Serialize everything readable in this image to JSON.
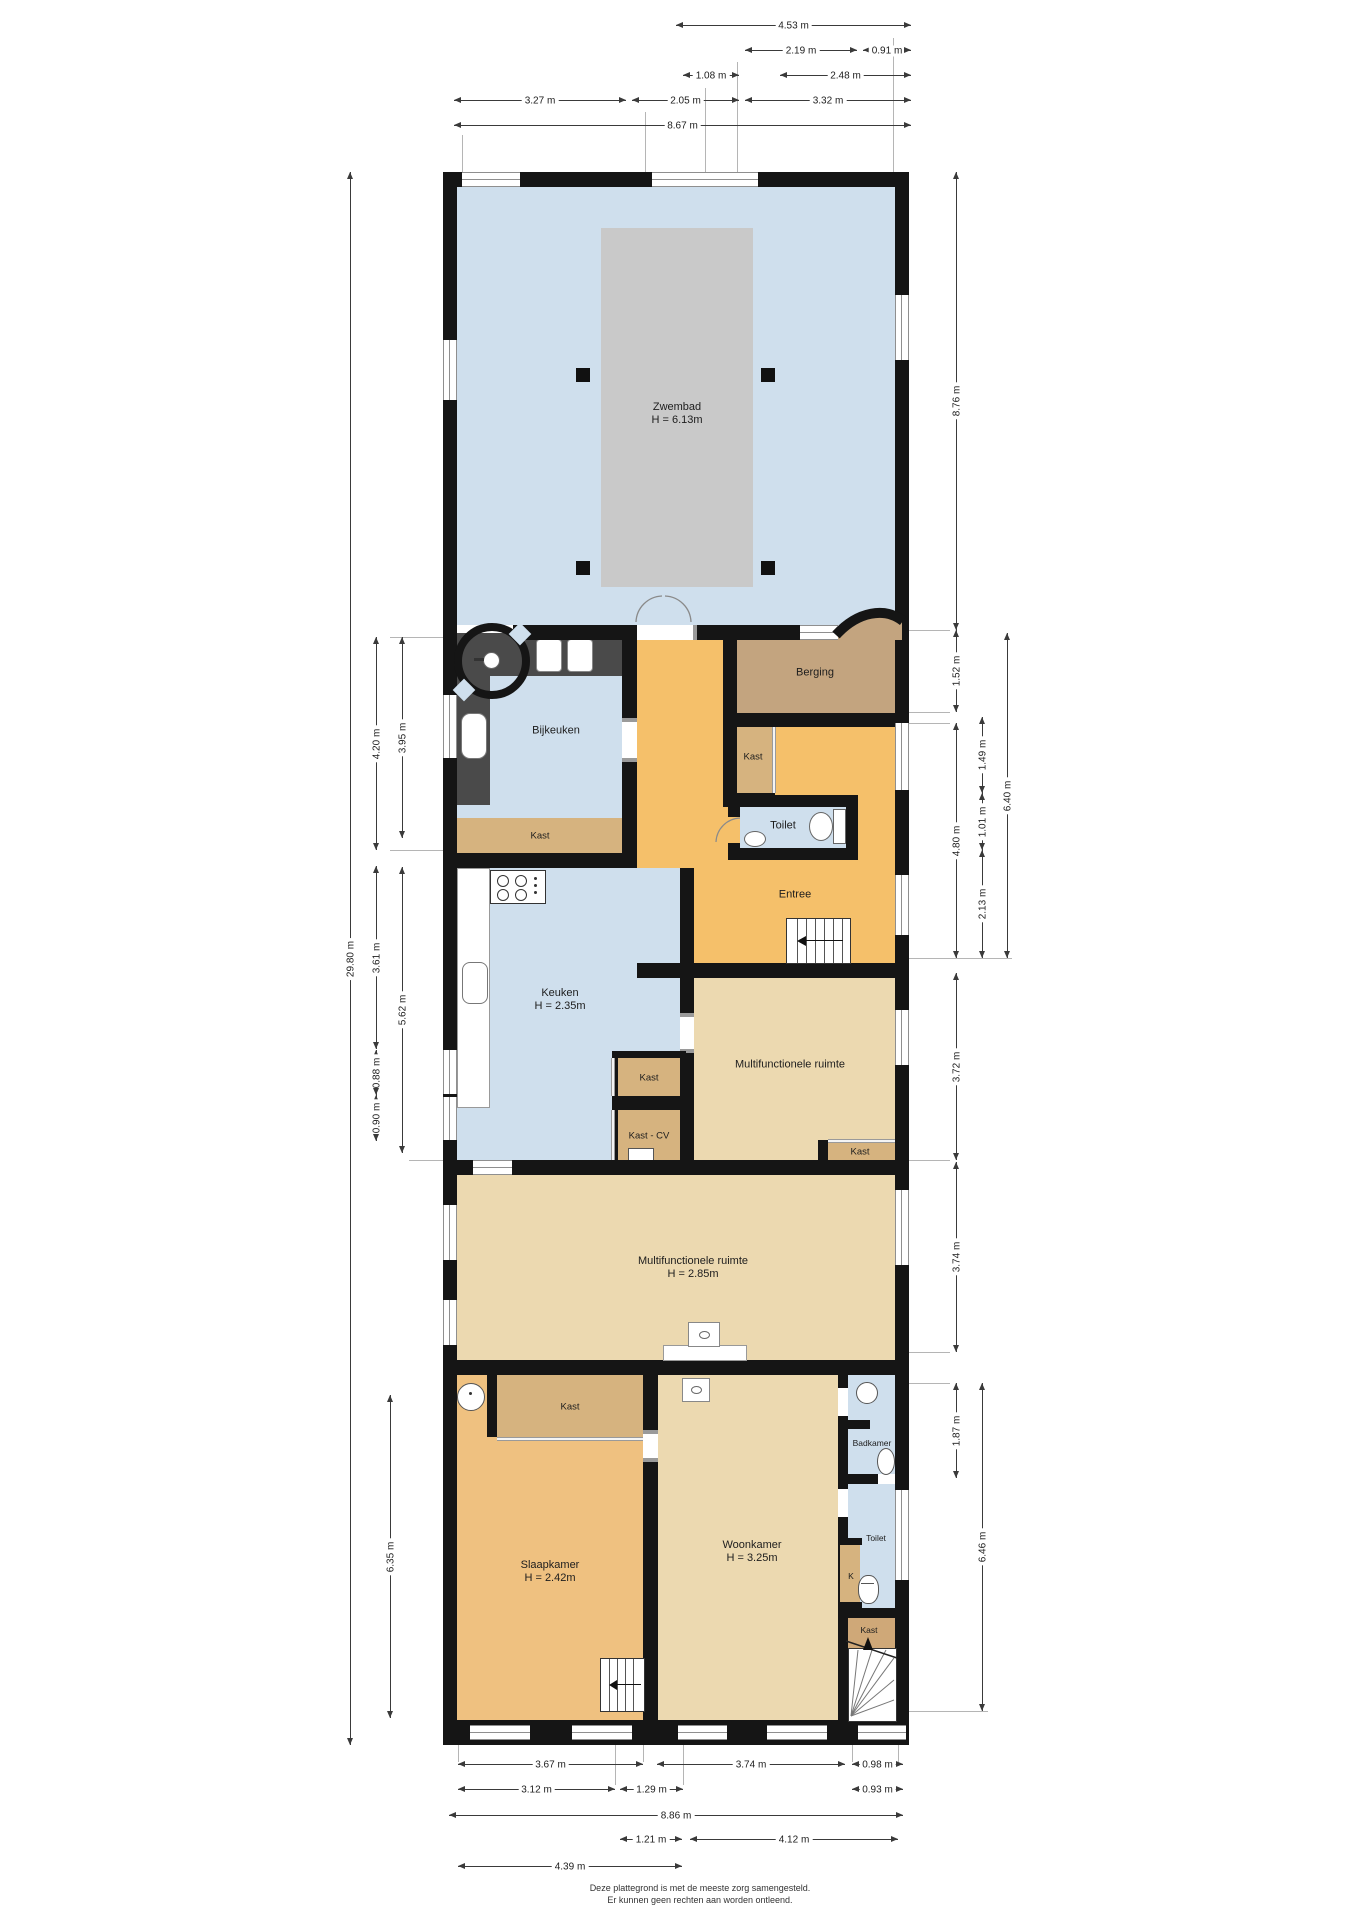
{
  "title": "Plattegrond begane grond",
  "colors": {
    "wall": "#151515",
    "pool_room": "#cfdfed",
    "pool": "#c9c9c9",
    "entree_orange": "#f5c06a",
    "bedroom_orange": "#efc180",
    "living_beige": "#ecd9b0",
    "berging_tan": "#c3a47f",
    "closet_tan": "#d6b37f",
    "wet_room_blue": "#cfdfed"
  },
  "room_labels": [
    {
      "label": "Zwembad",
      "sub": "H = 6.13m",
      "x": 677,
      "y": 414
    },
    {
      "label": "Bijkeuken",
      "x": 556,
      "y": 731
    },
    {
      "label": "Berging",
      "x": 815,
      "y": 673
    },
    {
      "label": "Kast",
      "x": 753,
      "y": 757,
      "size": "sm"
    },
    {
      "label": "Toilet",
      "x": 783,
      "y": 826
    },
    {
      "label": "Kast",
      "x": 540,
      "y": 836,
      "size": "sm"
    },
    {
      "label": "Entree",
      "x": 795,
      "y": 895
    },
    {
      "label": "Keuken",
      "sub": "H = 2.35m",
      "x": 560,
      "y": 1000
    },
    {
      "label": "Multifunctionele ruimte",
      "x": 790,
      "y": 1065
    },
    {
      "label": "Kast",
      "x": 649,
      "y": 1078,
      "size": "sm"
    },
    {
      "label": "Kast - CV",
      "x": 649,
      "y": 1136,
      "size": "sm"
    },
    {
      "label": "Kast",
      "x": 860,
      "y": 1152,
      "size": "sm"
    },
    {
      "label": "Multifunctionele ruimte",
      "sub": "H = 2.85m",
      "x": 693,
      "y": 1268
    },
    {
      "label": "Kast",
      "x": 570,
      "y": 1407,
      "size": "sm"
    },
    {
      "label": "Slaapkamer",
      "sub": "H = 2.42m",
      "x": 550,
      "y": 1572
    },
    {
      "label": "Woonkamer",
      "sub": "H = 3.25m",
      "x": 752,
      "y": 1552
    },
    {
      "label": "Badkamer",
      "x": 872,
      "y": 1443,
      "size": "xs"
    },
    {
      "label": "Toilet",
      "x": 876,
      "y": 1538,
      "size": "xs"
    },
    {
      "label": "K",
      "x": 851,
      "y": 1576,
      "size": "xs"
    },
    {
      "label": "Kast",
      "x": 869,
      "y": 1630,
      "size": "xs"
    }
  ],
  "dims_top": [
    {
      "label": "4.53 m",
      "x1": 676,
      "x2": 911,
      "y": 25
    },
    {
      "label": "2.19 m",
      "x1": 745,
      "x2": 857,
      "y": 50
    },
    {
      "label": "0.91 m",
      "x1": 863,
      "x2": 911,
      "y": 50
    },
    {
      "label": "1.08 m",
      "x1": 683,
      "x2": 739,
      "y": 75
    },
    {
      "label": "2.48 m",
      "x1": 780,
      "x2": 911,
      "y": 75
    },
    {
      "label": "3.27 m",
      "x1": 454,
      "x2": 626,
      "y": 100
    },
    {
      "label": "2.05 m",
      "x1": 632,
      "x2": 739,
      "y": 100
    },
    {
      "label": "3.32 m",
      "x1": 745,
      "x2": 911,
      "y": 100
    },
    {
      "label": "8.67 m",
      "x1": 454,
      "x2": 911,
      "y": 125
    }
  ],
  "dims_bottom": [
    {
      "label": "3.67 m",
      "x1": 458,
      "x2": 643,
      "y": 1764
    },
    {
      "label": "3.74 m",
      "x1": 657,
      "x2": 845,
      "y": 1764
    },
    {
      "label": "0.98 m",
      "x1": 852,
      "x2": 903,
      "y": 1764
    },
    {
      "label": "3.12 m",
      "x1": 458,
      "x2": 615,
      "y": 1789
    },
    {
      "label": "1.29 m",
      "x1": 620,
      "x2": 683,
      "y": 1789
    },
    {
      "label": "0.93 m",
      "x1": 852,
      "x2": 903,
      "y": 1789
    },
    {
      "label": "8.86 m",
      "x1": 449,
      "x2": 903,
      "y": 1815
    },
    {
      "label": "1.21 m",
      "x1": 620,
      "x2": 682,
      "y": 1839
    },
    {
      "label": "4.12 m",
      "x1": 690,
      "x2": 898,
      "y": 1839
    },
    {
      "label": "4.39 m",
      "x1": 458,
      "x2": 682,
      "y": 1866
    }
  ],
  "dims_left": [
    {
      "label": "29.80 m",
      "x": 350,
      "y1": 172,
      "y2": 1745
    },
    {
      "label": "4.20 m",
      "x": 376,
      "y1": 637,
      "y2": 850
    },
    {
      "label": "3.95 m",
      "x": 402,
      "y1": 637,
      "y2": 838
    },
    {
      "label": "3.61 m",
      "x": 376,
      "y1": 866,
      "y2": 1049
    },
    {
      "label": "5.62 m",
      "x": 402,
      "y1": 867,
      "y2": 1153
    },
    {
      "label": "0.88 m",
      "x": 376,
      "y1": 1050,
      "y2": 1095
    },
    {
      "label": "0.90 m",
      "x": 376,
      "y1": 1095,
      "y2": 1141
    },
    {
      "label": "6.35 m",
      "x": 390,
      "y1": 1395,
      "y2": 1718
    }
  ],
  "dims_right": [
    {
      "label": "8.76 m",
      "x": 956,
      "y1": 172,
      "y2": 630
    },
    {
      "label": "1.52 m",
      "x": 956,
      "y1": 630,
      "y2": 712
    },
    {
      "label": "1.49 m",
      "x": 982,
      "y1": 717,
      "y2": 793
    },
    {
      "label": "6.40 m",
      "x": 1007,
      "y1": 633,
      "y2": 958
    },
    {
      "label": "4.80 m",
      "x": 956,
      "y1": 723,
      "y2": 958
    },
    {
      "label": "1.01 m",
      "x": 982,
      "y1": 793,
      "y2": 850
    },
    {
      "label": "2.13 m",
      "x": 982,
      "y1": 850,
      "y2": 958
    },
    {
      "label": "3.72 m",
      "x": 956,
      "y1": 973,
      "y2": 1160
    },
    {
      "label": "3.74 m",
      "x": 956,
      "y1": 1162,
      "y2": 1352
    },
    {
      "label": "1.87 m",
      "x": 956,
      "y1": 1383,
      "y2": 1478
    },
    {
      "label": "6.46 m",
      "x": 982,
      "y1": 1383,
      "y2": 1711
    }
  ],
  "footer": {
    "line1": "Deze plattegrond is met de meeste zorg samengesteld.",
    "line2": "Er kunnen geen rechten aan worden ontleend."
  }
}
